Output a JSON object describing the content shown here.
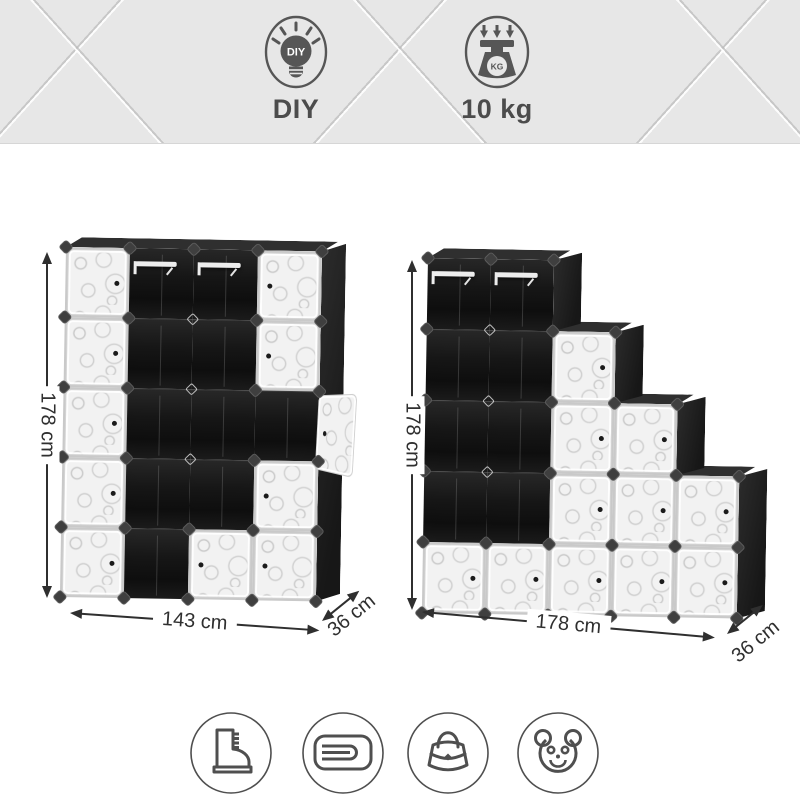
{
  "banner": {
    "diy": {
      "icon": "diy-lightbulb-icon",
      "bulb_text": "DIY",
      "label": "DIY"
    },
    "max_load": {
      "icon": "weight-scale-icon",
      "scale_badge": "KG",
      "label": "10 kg"
    }
  },
  "units": [
    {
      "name": "closet-organizer-20-cube",
      "dims": {
        "height": "178 cm",
        "width": "143 cm",
        "depth": "36 cm"
      },
      "columns": 4,
      "rows": 5,
      "col_start_row": [
        0,
        0,
        0,
        0
      ],
      "door_cells": [
        [
          0,
          0
        ],
        [
          1,
          0
        ],
        [
          2,
          0
        ],
        [
          3,
          0
        ],
        [
          4,
          0
        ],
        [
          4,
          2
        ],
        [
          0,
          3
        ],
        [
          1,
          3
        ],
        [
          3,
          3
        ],
        [
          4,
          3
        ]
      ],
      "knob_left_cells": [
        [
          4,
          2
        ],
        [
          0,
          3
        ],
        [
          1,
          3
        ],
        [
          3,
          3
        ],
        [
          4,
          3
        ]
      ],
      "open_door_cell": [
        2,
        3
      ],
      "rail_cells": [
        [
          0,
          1
        ],
        [
          0,
          2
        ]
      ]
    },
    {
      "name": "staircase-organizer-16-cube",
      "dims": {
        "height": "178 cm",
        "width": "178 cm",
        "depth": "36 cm"
      },
      "columns": 5,
      "rows": 5,
      "col_start_row": [
        0,
        0,
        1,
        2,
        3
      ],
      "door_cells": [
        [
          4,
          0
        ],
        [
          4,
          1
        ],
        [
          1,
          2
        ],
        [
          2,
          2
        ],
        [
          3,
          2
        ],
        [
          4,
          2
        ],
        [
          2,
          3
        ],
        [
          3,
          3
        ],
        [
          4,
          3
        ],
        [
          3,
          4
        ],
        [
          4,
          4
        ]
      ],
      "knob_left_cells": [],
      "rail_cells": [
        [
          0,
          0
        ],
        [
          0,
          1
        ]
      ]
    }
  ],
  "usage_icons": [
    {
      "name": "boot-icon"
    },
    {
      "name": "folded-towel-icon"
    },
    {
      "name": "handbag-icon"
    },
    {
      "name": "teddy-bear-icon"
    }
  ],
  "palette": {
    "banner_bg": "#e7e7e7",
    "icon_gray": "#545454",
    "panel_black": "#1a1a1a",
    "door_white": "#f2f2f2",
    "dim_color": "#2f2f2f"
  }
}
